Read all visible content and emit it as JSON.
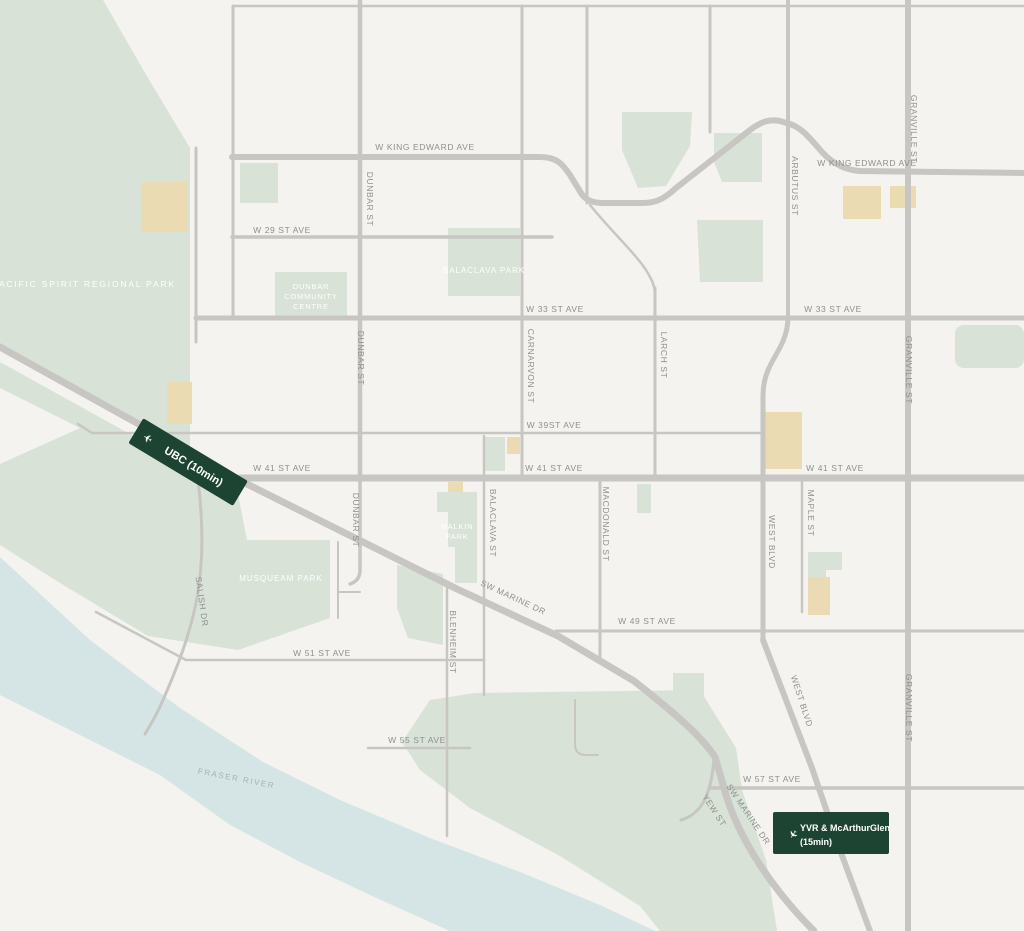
{
  "map_title": "Neighbourhood transit map - Dunbar / Kerrisdale, Vancouver",
  "colors": {
    "land": "#f4f3ef",
    "park": "#d8e2d6",
    "water": "#d5e5e6",
    "road": "#c7c6c3",
    "building": "#ebdbb2",
    "badge": "#1d4433",
    "badge_text": "#ffffff",
    "street_label": "#8f908c",
    "park_label": "#ffffff",
    "water_label": "#9db4b8"
  },
  "streets": {
    "king_edward": "W KING EDWARD AVE",
    "w29": "W 29 ST AVE",
    "w33": "W 33 ST AVE",
    "w39": "W 39ST AVE",
    "w41": "W 41 ST AVE",
    "w49": "W 49 ST AVE",
    "w51": "W 51 ST AVE",
    "w55": "W 55 ST AVE",
    "w57": "W 57 ST AVE",
    "dunbar": "DUNBAR ST",
    "carnarvon": "CARNARVON ST",
    "larch": "LARCH ST",
    "balaclava": "BALACLAVA ST",
    "macdonald": "MACDONALD ST",
    "blenheim": "BLENHEIM ST",
    "arbutus": "ARBUTUS ST",
    "granville": "GRANVILLE ST",
    "west_blvd": "WEST BLVD",
    "maple": "MAPLE ST",
    "yew": "YEW ST",
    "salish": "SALISH DR",
    "sw_marine": "SW MARINE DR"
  },
  "places": {
    "pacific_spirit": "PACIFIC SPIRIT REGIONAL PARK",
    "balaclava_park": "BALACLAVA PARK",
    "dunbar_cc": [
      "DUNBAR",
      "COMMUNITY",
      "CENTRE"
    ],
    "malkin": [
      "MALKIN",
      "PARK"
    ],
    "musqueam": "MUSQUEAM PARK",
    "fraser": "FRASER RIVER"
  },
  "badges": {
    "ubc": {
      "label": "UBC (10min)",
      "icon": "plane-left-icon",
      "icon_glyph": "✈"
    },
    "yvr": {
      "line1": "YVR & McArthurGlen",
      "line2": "(15min)",
      "icon": "plane-down-icon",
      "icon_glyph": "✈"
    }
  }
}
